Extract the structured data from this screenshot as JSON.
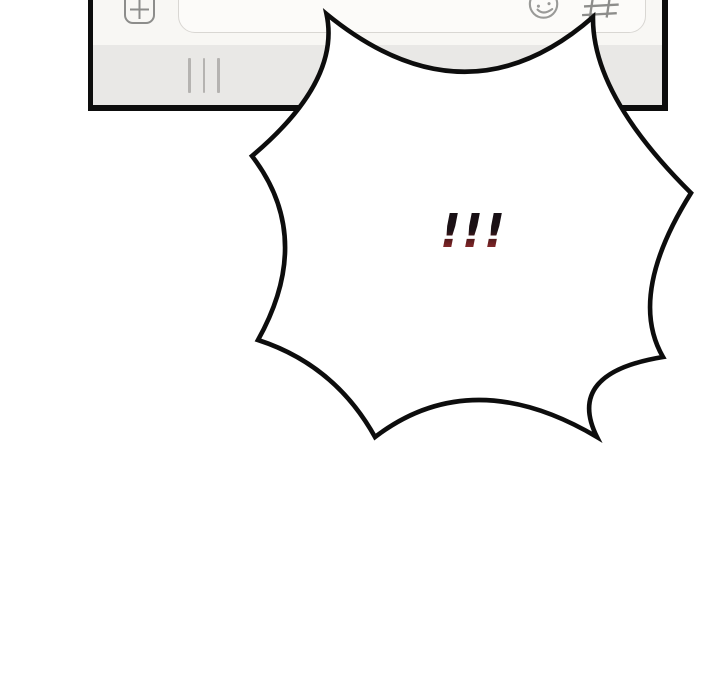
{
  "panel": {
    "type": "comic-panel",
    "background": "#ffffff"
  },
  "phone_ui": {
    "composer": {
      "attach_icon": "plus",
      "input_value": "",
      "emoji_icon": "smiley-face",
      "hashtag_icon": "hash"
    },
    "keyboard_bar": {
      "handle_icon": "three-vertical-lines"
    },
    "colors": {
      "frame_outline": "#0d0d0d",
      "composer_bg": "#f8f7f4",
      "keyboard_bg": "#e9e8e6",
      "field_bg": "#fcfbf9",
      "field_border": "#d9d7d3",
      "icon_gray": "#8d8d8b",
      "handle_gray": "#b5b3b1"
    }
  },
  "burst_bubble": {
    "text": "!!!",
    "fill": "#ffffff",
    "outline": "#0d0d0d",
    "text_gradient_top": "#151015",
    "text_gradient_bottom": "#a13a3a"
  }
}
